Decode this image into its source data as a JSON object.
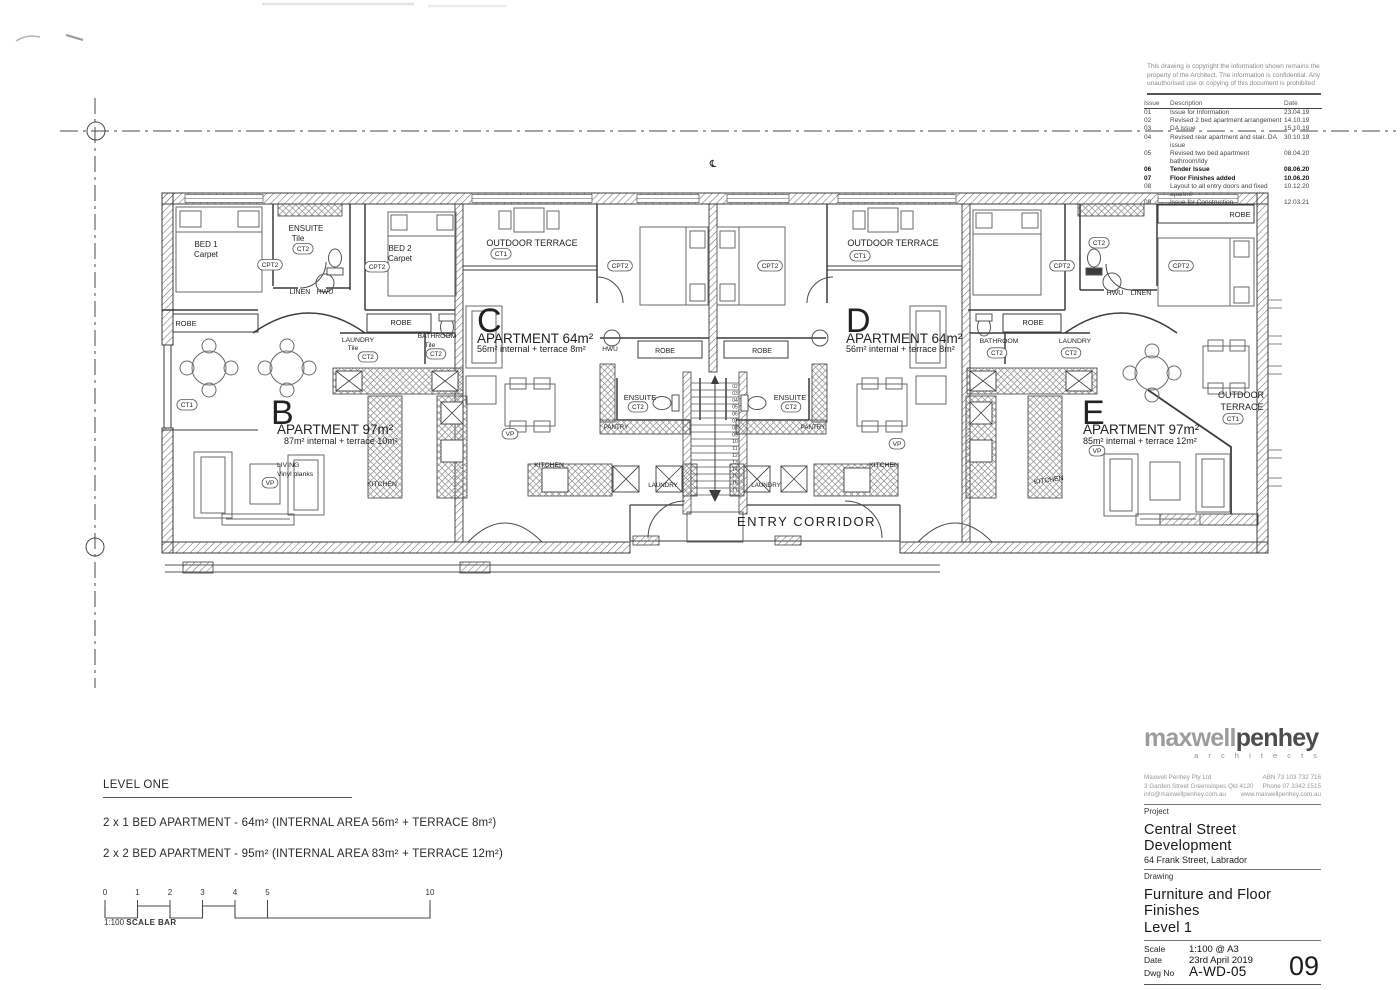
{
  "copyright": [
    "This drawing is copyright the information shown remains the",
    "property of the Architect. The information is confidential. Any",
    "unauthorised use or copying of this document is prohibited"
  ],
  "revisions": {
    "headers": [
      "Issue",
      "Description",
      "Date"
    ],
    "rows": [
      {
        "issue": "01",
        "description": "Issue for Information",
        "date": "23.04.19",
        "bold": false
      },
      {
        "issue": "02",
        "description": "Revised 2 bed apartment arrangement",
        "date": "14.10.19",
        "bold": false
      },
      {
        "issue": "03",
        "description": "DA issue",
        "date": "15.10.19",
        "bold": false
      },
      {
        "issue": "04",
        "description": "Revised rear apartment and stair. DA issue",
        "date": "30.10.19",
        "bold": false
      },
      {
        "issue": "05",
        "description": "Revised two bed apartment bathroom/ldy",
        "date": "08.04.20",
        "bold": false
      },
      {
        "issue": "06",
        "description": "Tender Issue",
        "date": "08.06.20",
        "bold": true
      },
      {
        "issue": "07",
        "description": "Floor Finishes added",
        "date": "10.06.20",
        "bold": true
      },
      {
        "issue": "08",
        "description": "Layout to all entry doors and fixed apartml",
        "date": "10.12.20",
        "bold": false
      },
      {
        "issue": "09",
        "description": "Issue for Construction",
        "date": "12.03.21",
        "bold": false
      }
    ]
  },
  "plan": {
    "centerline_symbol": "℄",
    "stair_numbers": [
      "02",
      "03",
      "04",
      "05",
      "06",
      "07",
      "08",
      "09",
      "10",
      "11",
      "12",
      "13",
      "14",
      "15",
      "16",
      "17"
    ],
    "labels": [
      {
        "t": "BED 1",
        "x": 206,
        "y": 247,
        "s": 8
      },
      {
        "t": "Carpet",
        "x": 206,
        "y": 257,
        "s": 8
      },
      {
        "t": "CPT2",
        "x": 270,
        "y": 267,
        "s": 6.5,
        "tag": 1
      },
      {
        "t": "ENSUITE",
        "x": 306,
        "y": 231,
        "s": 8
      },
      {
        "t": "Tile",
        "x": 298,
        "y": 241,
        "s": 8
      },
      {
        "t": "CT2",
        "x": 303,
        "y": 251,
        "s": 6.5,
        "tag": 1
      },
      {
        "t": "BED 2",
        "x": 400,
        "y": 251,
        "s": 8
      },
      {
        "t": "Carpet",
        "x": 400,
        "y": 261,
        "s": 8
      },
      {
        "t": "CPT2",
        "x": 377,
        "y": 269,
        "s": 6.5,
        "tag": 1
      },
      {
        "t": "LINEN",
        "x": 300,
        "y": 294,
        "s": 7
      },
      {
        "t": "HWU",
        "x": 325,
        "y": 294,
        "s": 7
      },
      {
        "t": "ROBE",
        "x": 186,
        "y": 326,
        "s": 7.5
      },
      {
        "t": "ROBE",
        "x": 401,
        "y": 325,
        "s": 7.5
      },
      {
        "t": "LAUNDRY",
        "x": 358,
        "y": 342,
        "s": 6.8
      },
      {
        "t": "Tile",
        "x": 353,
        "y": 350,
        "s": 6.8
      },
      {
        "t": "CT2",
        "x": 368,
        "y": 359,
        "s": 6.2,
        "tag": 1
      },
      {
        "t": "BATHROOM",
        "x": 437,
        "y": 338,
        "s": 6.8
      },
      {
        "t": "Tile",
        "x": 430,
        "y": 347,
        "s": 6.8
      },
      {
        "t": "CT2",
        "x": 436,
        "y": 356,
        "s": 6.2,
        "tag": 1
      },
      {
        "t": "CT1",
        "x": 187,
        "y": 407,
        "s": 6.5,
        "tag": 1
      },
      {
        "t": "B",
        "x": 271,
        "y": 424,
        "s": 34,
        "a": "s"
      },
      {
        "t": "APARTMENT  97m²",
        "x": 277,
        "y": 434,
        "s": 13.5,
        "a": "s"
      },
      {
        "t": "87m² internal + terrace 10m²",
        "x": 284,
        "y": 444,
        "s": 9,
        "a": "s"
      },
      {
        "t": "LIVING",
        "x": 277,
        "y": 467,
        "s": 6.8,
        "a": "s"
      },
      {
        "t": "Vinyl planks",
        "x": 277,
        "y": 476,
        "s": 6.8,
        "a": "s"
      },
      {
        "t": "VP",
        "x": 270,
        "y": 485,
        "s": 6.5,
        "tag": 1
      },
      {
        "t": "KITCHEN",
        "x": 382,
        "y": 486,
        "s": 6.8
      },
      {
        "t": "OUTDOOR TERRACE",
        "x": 532,
        "y": 246,
        "s": 9
      },
      {
        "t": "CT1",
        "x": 501,
        "y": 256,
        "s": 6.5,
        "tag": 1
      },
      {
        "t": "CPT2",
        "x": 620,
        "y": 268,
        "s": 6.5,
        "tag": 1
      },
      {
        "t": "C",
        "x": 477,
        "y": 332,
        "s": 34,
        "a": "s"
      },
      {
        "t": "APARTMENT  64m²",
        "x": 477,
        "y": 343,
        "s": 13.5,
        "a": "s"
      },
      {
        "t": "56m² internal + terrace 8m²",
        "x": 477,
        "y": 352,
        "s": 9,
        "a": "s"
      },
      {
        "t": "HWU",
        "x": 610,
        "y": 351,
        "s": 6.5
      },
      {
        "t": "ROBE",
        "x": 665,
        "y": 353,
        "s": 7
      },
      {
        "t": "ENSUITE",
        "x": 640,
        "y": 400,
        "s": 7.5
      },
      {
        "t": "CT2",
        "x": 638,
        "y": 409,
        "s": 6.2,
        "tag": 1
      },
      {
        "t": "PANTRY",
        "x": 616,
        "y": 429,
        "s": 6.2
      },
      {
        "t": "VP",
        "x": 510,
        "y": 436,
        "s": 6.5,
        "tag": 1
      },
      {
        "t": "KITCHEN",
        "x": 549,
        "y": 467,
        "s": 6.8
      },
      {
        "t": "LAUNDRY",
        "x": 663,
        "y": 487,
        "s": 6.2
      },
      {
        "t": "℄",
        "x": 713,
        "y": 167,
        "s": 10
      },
      {
        "t": "ENTRY CORRIDOR",
        "x": 737,
        "y": 526,
        "s": 13,
        "a": "s",
        "ls": 1.5
      },
      {
        "t": "OUTDOOR TERRACE",
        "x": 893,
        "y": 246,
        "s": 9
      },
      {
        "t": "CT1",
        "x": 860,
        "y": 258,
        "s": 6.5,
        "tag": 1
      },
      {
        "t": "CPT2",
        "x": 770,
        "y": 268,
        "s": 6.5,
        "tag": 1
      },
      {
        "t": "D",
        "x": 846,
        "y": 332,
        "s": 34,
        "a": "s"
      },
      {
        "t": "APARTMENT  64m²",
        "x": 846,
        "y": 343,
        "s": 13.5,
        "a": "s"
      },
      {
        "t": "56m² internal + terrace 8m²",
        "x": 846,
        "y": 352,
        "s": 9,
        "a": "s"
      },
      {
        "t": "ROBE",
        "x": 762,
        "y": 353,
        "s": 7
      },
      {
        "t": "ENSUITE",
        "x": 790,
        "y": 400,
        "s": 7.5
      },
      {
        "t": "CT2",
        "x": 791,
        "y": 409,
        "s": 6.2,
        "tag": 1
      },
      {
        "t": "PANTRY",
        "x": 813,
        "y": 429,
        "s": 6.2
      },
      {
        "t": "VP",
        "x": 897,
        "y": 446,
        "s": 6.5,
        "tag": 1
      },
      {
        "t": "KITCHEN",
        "x": 884,
        "y": 467,
        "s": 6.8
      },
      {
        "t": "LAUNDRY",
        "x": 766,
        "y": 487,
        "s": 6.2
      },
      {
        "t": "ROBE",
        "x": 1240,
        "y": 217,
        "s": 7.5
      },
      {
        "t": "CT2",
        "x": 1099,
        "y": 245,
        "s": 6.5,
        "tag": 1
      },
      {
        "t": "CPT2",
        "x": 1062,
        "y": 268,
        "s": 6.5,
        "tag": 1
      },
      {
        "t": "CPT2",
        "x": 1181,
        "y": 268,
        "s": 6.5,
        "tag": 1
      },
      {
        "t": "HWU",
        "x": 1115,
        "y": 295,
        "s": 7
      },
      {
        "t": "LINEN",
        "x": 1141,
        "y": 295,
        "s": 7
      },
      {
        "t": "ROBE",
        "x": 1033,
        "y": 325,
        "s": 7.5
      },
      {
        "t": "BATHROOM",
        "x": 999,
        "y": 343,
        "s": 6.8
      },
      {
        "t": "CT2",
        "x": 997,
        "y": 355,
        "s": 6.2,
        "tag": 1
      },
      {
        "t": "LAUNDRY",
        "x": 1075,
        "y": 343,
        "s": 6.8
      },
      {
        "t": "CT2",
        "x": 1071,
        "y": 355,
        "s": 6.2,
        "tag": 1
      },
      {
        "t": "E",
        "x": 1082,
        "y": 424,
        "s": 34,
        "a": "s"
      },
      {
        "t": "APARTMENT  97m²",
        "x": 1083,
        "y": 434,
        "s": 13.5,
        "a": "s"
      },
      {
        "t": "85m² internal + terrace 12m²",
        "x": 1083,
        "y": 444,
        "s": 9,
        "a": "s"
      },
      {
        "t": "VP",
        "x": 1097,
        "y": 453,
        "s": 6.5,
        "tag": 1
      },
      {
        "t": "KITCHEN",
        "x": 1049,
        "y": 482,
        "s": 6.8,
        "rot": -8
      },
      {
        "t": "OUTDOOR",
        "x": 1241,
        "y": 398,
        "s": 9
      },
      {
        "t": "TERRACE",
        "x": 1242,
        "y": 410,
        "s": 9
      },
      {
        "t": "CT1",
        "x": 1233,
        "y": 421,
        "s": 6.5,
        "tag": 1
      }
    ]
  },
  "legend": {
    "title": "LEVEL ONE",
    "lines": [
      "2 x 1 BED APARTMENT - 64m² (INTERNAL AREA 56m² + TERRACE 8m²)",
      "2 x 2 BED APARTMENT - 95m²  (INTERNAL AREA 83m² + TERRACE 12m²)"
    ]
  },
  "scale_bar": {
    "ratio": "1:100",
    "label": "SCALE BAR",
    "ticks": [
      {
        "label": "0",
        "x": 5
      },
      {
        "label": "1",
        "x": 37.5
      },
      {
        "label": "2",
        "x": 70
      },
      {
        "label": "3",
        "x": 102.5
      },
      {
        "label": "4",
        "x": 135
      },
      {
        "label": "5",
        "x": 167.5
      },
      {
        "label": "10",
        "x": 330
      }
    ]
  },
  "title_block": {
    "logo_primary": "maxwell",
    "logo_secondary": "penhey",
    "logo_sub": "a r c h i t e c t s",
    "company": "Maxwell Penhey Pty Ltd",
    "abn": "ABN 73 103 732 716",
    "address": "3 Garden Street  Greenslopes  Qld 4120",
    "phone": "Phone 07 3342 1515",
    "email": "info@maxwellpenhey.com.au",
    "web": "www.maxwellpenhey.com.au",
    "project_label": "Project",
    "project_name": "Central Street Development",
    "project_address": "64 Frank Street, Labrador",
    "drawing_label": "Drawing",
    "drawing_name": "Furniture and Floor Finishes",
    "drawing_name2": "Level 1",
    "scale_label": "Scale",
    "scale_value": "1:100 @ A3",
    "date_label": "Date",
    "date_value": "23rd April 2019",
    "dwg_label": "Dwg No",
    "dwg_value": "A-WD-05",
    "issue_number": "09"
  }
}
